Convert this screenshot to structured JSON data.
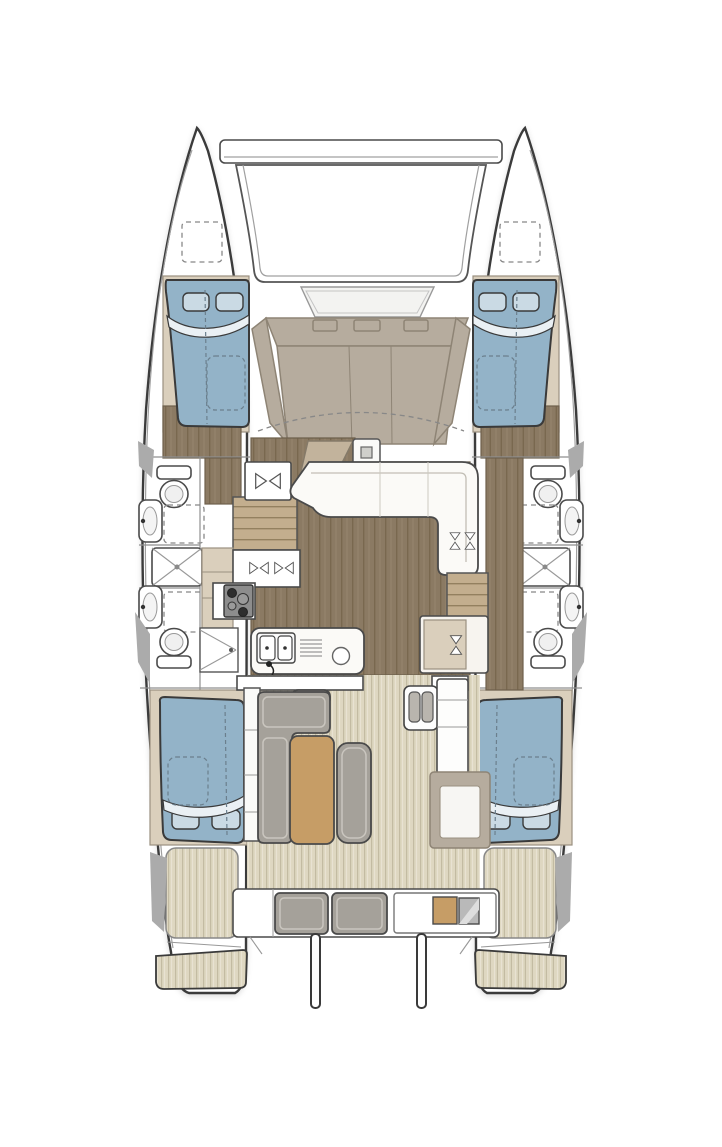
{
  "meta": {
    "label": "Catamaran yacht interior layout — overhead floor plan",
    "view": "top-down"
  },
  "colors": {
    "outline": "#3a3a3a",
    "line_soft": "#a0a0a0",
    "fixture_line": "#4a4a4a",
    "bed_blue": "#93b3c8",
    "pillow_blue": "#cadae4",
    "blanket_white": "#eaf0f4",
    "wood_floor": "#8b7a63",
    "wood_line": "#79684f",
    "stair_wood": "#c3ae8e",
    "stair_line": "#93805f",
    "cabinet_beige": "#dacfbc",
    "cabinet_taupe": "#c2b39c",
    "bench_taupe": "#b6ac9e",
    "bench_line": "#8e8475",
    "teak_deck": "#ded7c1",
    "teak_line": "#c3bba2",
    "sofa_gray": "#a5a19a",
    "sofa_light": "#cac6bf",
    "table_wood": "#c69d66",
    "gunwale_gray": "#ababab",
    "steel_gray": "#b9b9b9",
    "cooktop_gray": "#8d8d8d",
    "dash_blue": "#6b7f8d"
  },
  "areas": {
    "bow": "crossbeam and trampoline",
    "foredeck": "forward bench seat with hatch",
    "cabins": [
      "port forward cabin",
      "starboard forward cabin",
      "port aft cabin",
      "starboard aft cabin"
    ],
    "heads": [
      "port forward head with shower",
      "port aft head",
      "starboard forward head with shower",
      "starboard aft head"
    ],
    "galley": "port-side galley: 4-burner cooktop, twin sink island, cabinets",
    "salon": "settee, mast post, nav cabinet, companionway stairs both hulls",
    "cockpit": "L-sofa with wood table, ottoman, sliding door, module",
    "stern": "aft bench with cushions and grill module, davits, twin swim platforms"
  }
}
